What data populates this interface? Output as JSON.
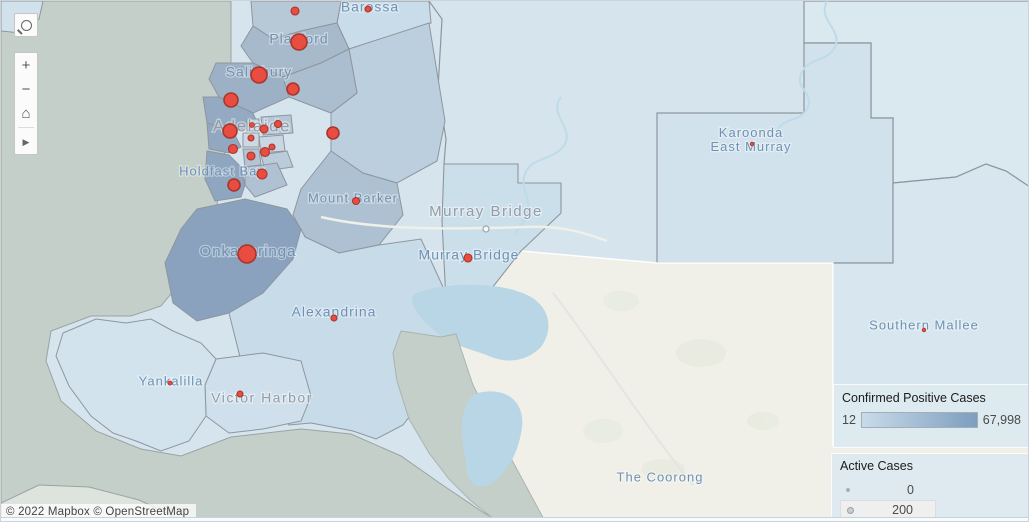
{
  "attribution": {
    "text": "© 2022 Mapbox © OpenStreetMap"
  },
  "toolbar": {
    "search_icon": "magnifier",
    "zoom_in_label": "+",
    "zoom_out_label": "−",
    "home_icon": "⌂",
    "pan_icon": "▶"
  },
  "legend_confirmed": {
    "title": "Confirmed Positive Cases",
    "min_label": "12",
    "max_label": "67,998",
    "gradient_start": "#c8dbe9",
    "gradient_end": "#7d9ec0"
  },
  "legend_active": {
    "title": "Active Cases",
    "items": [
      {
        "label": "0",
        "dot_px": 4,
        "highlighted": false
      },
      {
        "label": "200",
        "dot_px": 7,
        "highlighted": true
      }
    ]
  },
  "map": {
    "colors": {
      "base": "#d6e4ee",
      "sea": "#c4cfca",
      "cream": "#f0efe8",
      "lake": "#b8d6e5",
      "border": "#8e969d",
      "coast": "#9aa3a1",
      "case_fill": "#e94c40",
      "case_stroke": "#a8362b",
      "label_region": "#6d92b4",
      "label_city": "#939ca6",
      "region_light_1": "#d2e2ec",
      "region_light_2": "#dae8f0",
      "region_light_3": "#d7e6ef",
      "murray_bridge_fill": "#cbdfeb",
      "barossa_fill": "#c9dce9",
      "hills_fill": "#bccfdf",
      "mount_barker_fill": "#aec1d2",
      "gawler_fill": "#b7c8d7",
      "playford_fill": "#a7bacc",
      "salisbury_fill": "#9db1c6",
      "tea_tree_fill": "#abbed0",
      "port_adelaide_fill": "#93aac2",
      "west_torrens_fill": "#91a8c0",
      "marion_fill": "#8ea6c0",
      "mitcham_fill": "#afc1d2",
      "onkaparinga_fill": "#8aa2be",
      "alexandrina_fill": "#c7dbe9",
      "victor_harbor_fill": "#cfe0ec",
      "yankalilla_fill": "#d2e3ee",
      "island_fill": "#dde4de",
      "inner_a": "#ccd9e5",
      "inner_b": "#c4d4e2",
      "inner_c": "#b5c7d7",
      "inner_d": "#c9d7e4",
      "inner_e": "#bacbd9",
      "inner_f": "#b3c4d5",
      "river": "#bedbe8",
      "road": "#eef0e9",
      "veg": "#e8ebdf"
    },
    "region_labels": [
      {
        "text": "Barossa",
        "x": 369,
        "y": 7,
        "size": 14
      },
      {
        "text": "Playford",
        "x": 298,
        "y": 39,
        "size": 14
      },
      {
        "text": "Salisbury",
        "x": 258,
        "y": 72,
        "size": 14
      },
      {
        "text": "Holdfast Bay",
        "x": 221,
        "y": 171,
        "size": 13
      },
      {
        "text": "Mount Barker",
        "x": 352,
        "y": 198,
        "size": 13
      },
      {
        "text": "Onkaparinga",
        "x": 247,
        "y": 251,
        "size": 15
      },
      {
        "text": "Murray Bridge",
        "x": 468,
        "y": 255,
        "size": 14
      },
      {
        "text": "Alexandrina",
        "x": 333,
        "y": 312,
        "size": 14
      },
      {
        "text": "Yankalilla",
        "x": 170,
        "y": 381,
        "size": 13
      },
      {
        "lines": [
          "Karoonda",
          "East Murray"
        ],
        "x": 750,
        "y": 133,
        "size": 13
      },
      {
        "text": "Southern Mallee",
        "x": 923,
        "y": 325,
        "size": 13
      },
      {
        "text": "The Coorong",
        "x": 659,
        "y": 477,
        "size": 13
      }
    ],
    "city_labels": [
      {
        "text": "Adelaide",
        "x": 251,
        "y": 126,
        "size": 17
      },
      {
        "text": "Murray Bridge",
        "x": 485,
        "y": 211,
        "size": 15,
        "marker": {
          "x": 485,
          "y": 228
        }
      },
      {
        "text": "Victor Harbor",
        "x": 261,
        "y": 398,
        "size": 14
      }
    ],
    "active_case_marks": [
      {
        "x": 294,
        "y": 10,
        "r": 4
      },
      {
        "x": 367,
        "y": 8,
        "r": 3
      },
      {
        "x": 298,
        "y": 41,
        "r": 8
      },
      {
        "x": 258,
        "y": 74,
        "r": 8
      },
      {
        "x": 292,
        "y": 88,
        "r": 6
      },
      {
        "x": 230,
        "y": 99,
        "r": 7
      },
      {
        "x": 229,
        "y": 130,
        "r": 7
      },
      {
        "x": 251,
        "y": 124,
        "r": 2.5
      },
      {
        "x": 263,
        "y": 128,
        "r": 4
      },
      {
        "x": 277,
        "y": 123,
        "r": 3.5
      },
      {
        "x": 332,
        "y": 132,
        "r": 6
      },
      {
        "x": 250,
        "y": 137,
        "r": 3
      },
      {
        "x": 232,
        "y": 148,
        "r": 4.5
      },
      {
        "x": 250,
        "y": 155,
        "r": 4
      },
      {
        "x": 264,
        "y": 151,
        "r": 4.5
      },
      {
        "x": 271,
        "y": 146,
        "r": 3
      },
      {
        "x": 261,
        "y": 173,
        "r": 5
      },
      {
        "x": 233,
        "y": 184,
        "r": 6
      },
      {
        "x": 246,
        "y": 253,
        "r": 9
      },
      {
        "x": 355,
        "y": 200,
        "r": 3.5
      },
      {
        "x": 467,
        "y": 257,
        "r": 4
      },
      {
        "x": 333,
        "y": 317,
        "r": 3
      },
      {
        "x": 169,
        "y": 382,
        "r": 2
      },
      {
        "x": 239,
        "y": 393,
        "r": 3
      },
      {
        "x": 751,
        "y": 143,
        "r": 1.8
      },
      {
        "x": 923,
        "y": 329,
        "r": 1.8
      }
    ]
  }
}
